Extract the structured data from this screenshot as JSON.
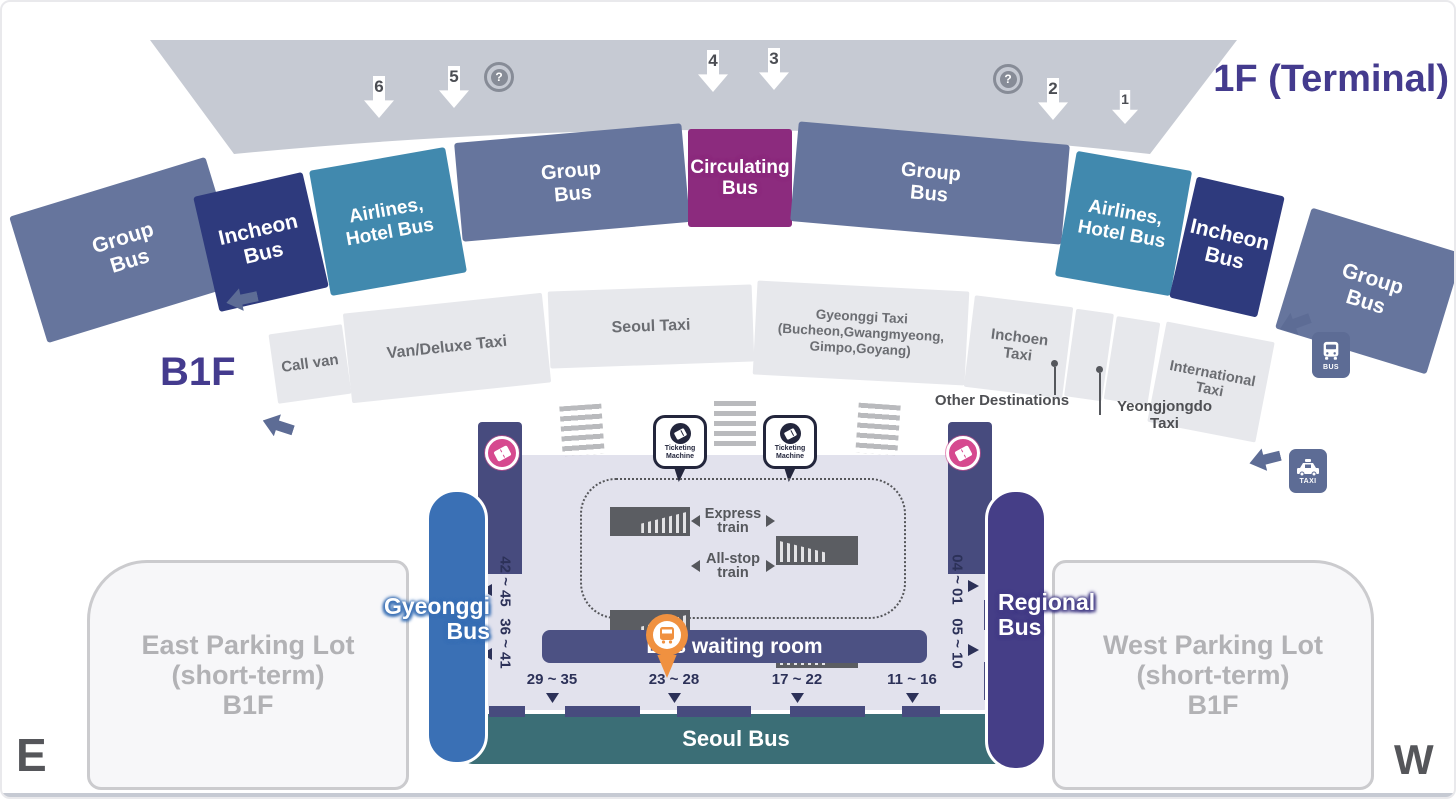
{
  "titles": {
    "terminal": "1F (Terminal)",
    "transit_center": "B1 (Transit Center)",
    "b1f": "B1F",
    "east": "E",
    "west": "W"
  },
  "help_symbol": "?",
  "terminal_gates": [
    "6",
    "5",
    "4",
    "3",
    "2",
    "1"
  ],
  "bus_row": [
    {
      "label": "Group Bus"
    },
    {
      "label": "Incheon Bus"
    },
    {
      "label": "Airlines, Hotel Bus"
    },
    {
      "label": "Group Bus"
    },
    {
      "label": "Circulating Bus"
    },
    {
      "label": "Group Bus"
    },
    {
      "label": "Airlines, Hotel Bus"
    },
    {
      "label": "Incheon Bus"
    },
    {
      "label": "Group Bus"
    }
  ],
  "taxi_row": [
    {
      "label": "Call van"
    },
    {
      "label": "Van/Deluxe Taxi"
    },
    {
      "label": "Seoul Taxi"
    },
    {
      "label": "Gyeonggi Taxi (Bucheon,Gwangmyeong, Gimpo,Goyang)"
    },
    {
      "label": "Inchoen Taxi"
    },
    {
      "label": ""
    },
    {
      "label": ""
    },
    {
      "label": "International Taxi"
    }
  ],
  "taxi_callouts": {
    "other_destinations": "Other Destinations",
    "yeongjongdo": "Yeongjongdo Taxi"
  },
  "transit_center": {
    "ticketing_machine": "Ticketing Machine",
    "express_train": "Express train",
    "all_stop_train": "All-stop train",
    "bus_waiting_room": "Bus waiting room",
    "seoul_bus": "Seoul Bus",
    "gyeonggi_bus": "Gyeonggi Bus",
    "regional_bus": "Regional Bus",
    "stops_bottom": [
      "29 ~ 35",
      "23 ~ 28",
      "17 ~ 22",
      "11 ~ 16"
    ],
    "stops_left": [
      "42 ~ 45",
      "36 ~ 41"
    ],
    "stops_right": [
      "04 ~ 01",
      "05 ~ 10"
    ]
  },
  "signs": {
    "bus": "BUS",
    "taxi": "TAXI"
  },
  "parking": {
    "east": {
      "line1": "East Parking Lot",
      "line2": "(short-term)",
      "line3": "B1F"
    },
    "west": {
      "line1": "West Parking Lot",
      "line2": "(short-term)",
      "line3": "B1F"
    }
  },
  "colors": {
    "terminal_band": "#c6cad3",
    "group_bus": "#66759d",
    "incheon_bus": "#2e3a7d",
    "airlines_hotel_bus": "#4189ae",
    "circulating_bus": "#8c2b7e",
    "taxi_band": "#e7e8ec",
    "seoul_bus": "#3b6e76",
    "gyeonggi_bus": "#3a70b5",
    "regional_bus": "#453e87",
    "heading": "#443b8e",
    "location_pin": "#f09140",
    "ticket_badge": "#d6498f"
  }
}
